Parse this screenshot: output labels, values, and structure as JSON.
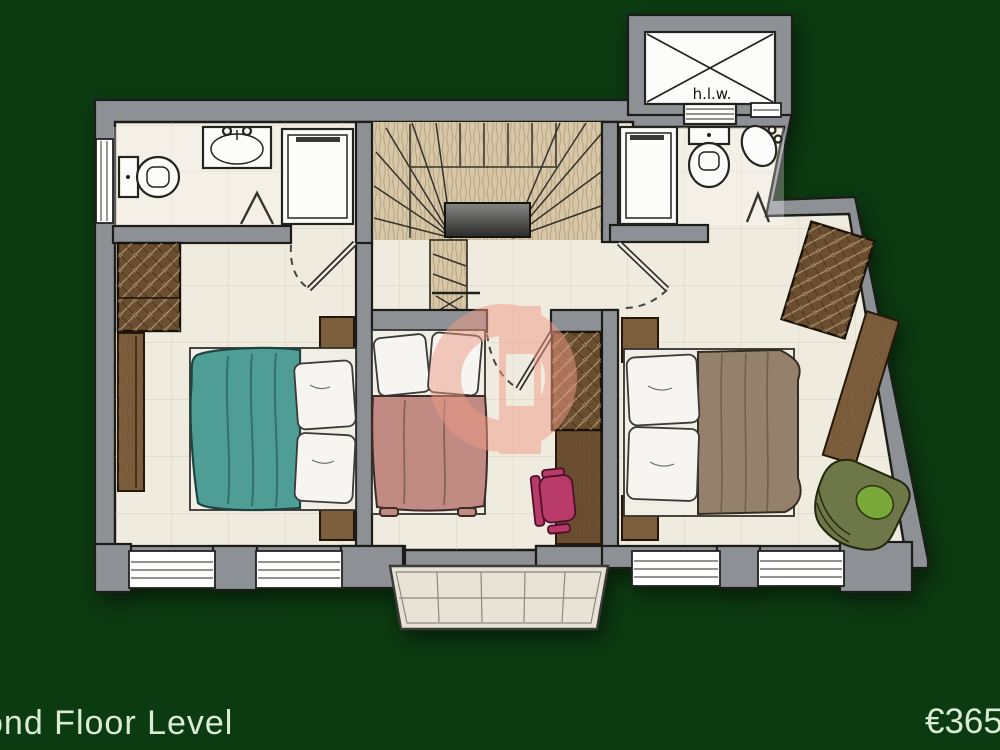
{
  "footer": {
    "floor_label": "ond Floor Level",
    "price": "€365"
  },
  "plan": {
    "hlw_label": "h.l.w.",
    "rooms": [
      "bathroom-left",
      "bathroom-right",
      "stair-hall",
      "bedroom-left",
      "bedroom-middle",
      "bedroom-right",
      "balcony"
    ],
    "furniture": [
      "toilet",
      "sink",
      "shower",
      "wardrobe",
      "sideboard",
      "double-bed-teal",
      "single-bed-pink",
      "double-bed-brown",
      "desk",
      "desk-chair",
      "armchair",
      "hot-linen-water-cupboard",
      "winder-staircase"
    ]
  },
  "colors": {
    "bg": "#0c3a11",
    "footer-text": "#daecd6",
    "wall": "#8d9196",
    "outline": "#1c1c18",
    "floor": "#f0ebdf",
    "stair-wood": "#d8c7a6",
    "fixture": "#fcfcfb",
    "wood": "#7c5e3d",
    "wood-dark": "#6b4e30",
    "teal": "#4f9e95",
    "teal-dark": "#23524c",
    "pink-duvet": "#c18a82",
    "brown-duvet": "#95816b",
    "pillow": "#f7f5f1",
    "chair-pink": "#b73a69",
    "armchair": "#6d7748",
    "cushion": "#7aa93a",
    "balcony": "#e9e3d7",
    "watermark": "#ef9b86"
  }
}
